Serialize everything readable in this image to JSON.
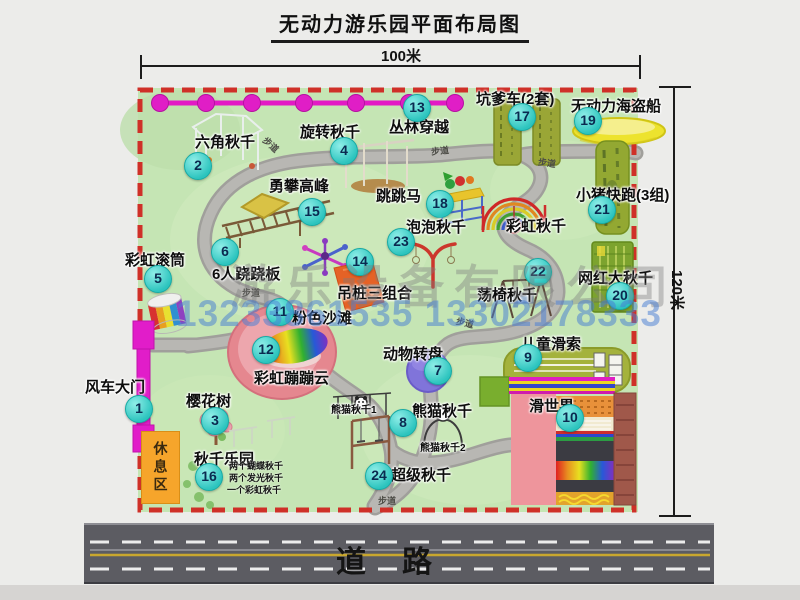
{
  "title": "无动力游乐园平面布局图",
  "dimensions": {
    "top": "100米",
    "right": "120米"
  },
  "road": {
    "label": "道路"
  },
  "watermark": {
    "company": "游乐设备有限公司",
    "phone": "13233861535 13302178333"
  },
  "rest_area": "休息区",
  "items": [
    {
      "num": 1,
      "label": "风车大门",
      "lx": 85,
      "ly": 376,
      "bx": 139,
      "by": 409
    },
    {
      "num": 2,
      "label": "六角秋千",
      "lx": 195,
      "ly": 131,
      "bx": 198,
      "by": 166
    },
    {
      "num": 3,
      "label": "樱花树",
      "lx": 186,
      "ly": 390,
      "bx": 215,
      "by": 421
    },
    {
      "num": 4,
      "label": "旋转秋千",
      "lx": 300,
      "ly": 121,
      "bx": 344,
      "by": 151
    },
    {
      "num": 5,
      "label": "彩虹滚筒",
      "lx": 125,
      "ly": 249,
      "bx": 158,
      "by": 279
    },
    {
      "num": 6,
      "label": "6人跷跷板",
      "lx": 212,
      "ly": 263,
      "bx": 225,
      "by": 252
    },
    {
      "num": 7,
      "label": "动物转盘",
      "lx": 383,
      "ly": 343,
      "bx": 438,
      "by": 371
    },
    {
      "num": 8,
      "label": "熊猫秋千",
      "lx": 412,
      "ly": 400,
      "bx": 403,
      "by": 423
    },
    {
      "num": 9,
      "label": "儿童滑索",
      "lx": 521,
      "ly": 333,
      "bx": 528,
      "by": 358
    },
    {
      "num": 10,
      "label": "滑世界",
      "lx": 529,
      "ly": 395,
      "bx": 570,
      "by": 418
    },
    {
      "num": 11,
      "label": "粉色沙滩",
      "lx": 292,
      "ly": 307,
      "bx": 280,
      "by": 312
    },
    {
      "num": 12,
      "label": "彩虹蹦蹦云",
      "lx": 254,
      "ly": 367,
      "bx": 266,
      "by": 350
    },
    {
      "num": 13,
      "label": "丛林穿越",
      "lx": 389,
      "ly": 116,
      "bx": 417,
      "by": 108
    },
    {
      "num": 14,
      "label": "吊桩三组合",
      "lx": 337,
      "ly": 282,
      "bx": 360,
      "by": 262
    },
    {
      "num": 15,
      "label": "勇攀高峰",
      "lx": 269,
      "ly": 175,
      "bx": 312,
      "by": 212
    },
    {
      "num": 16,
      "label": "秋千乐园",
      "lx": 194,
      "ly": 448,
      "bx": 209,
      "by": 477,
      "sub": [
        {
          "t": "两个蝴蝶秋千",
          "x": 229,
          "y": 459
        },
        {
          "t": "两个发光秋千",
          "x": 229,
          "y": 471
        },
        {
          "t": "一个彩虹秋千",
          "x": 227,
          "y": 483
        }
      ]
    },
    {
      "num": 17,
      "label": "坑爹车(2套)",
      "lx": 476,
      "ly": 88,
      "bx": 522,
      "by": 117
    },
    {
      "num": 18,
      "label": "跳跳马",
      "lx": 376,
      "ly": 185,
      "bx": 440,
      "by": 204
    },
    {
      "num": 19,
      "label": "无动力海盗船",
      "lx": 571,
      "ly": 95,
      "bx": 588,
      "by": 121
    },
    {
      "num": 20,
      "label": "网红大秋千",
      "lx": 578,
      "ly": 267,
      "bx": 620,
      "by": 296
    },
    {
      "num": 21,
      "label": "小猪快跑(3组)",
      "lx": 576,
      "ly": 184,
      "bx": 602,
      "by": 210
    },
    {
      "num": 22,
      "label": "荡椅秋千",
      "lx": 477,
      "ly": 284,
      "bx": 538,
      "by": 272
    },
    {
      "num": 23,
      "label": "泡泡秋千",
      "lx": 406,
      "ly": 216,
      "bx": 401,
      "by": 242
    },
    {
      "num": 24,
      "label": "超级秋千",
      "lx": 391,
      "ly": 464,
      "bx": 379,
      "by": 476
    }
  ],
  "extra_labels": [
    {
      "t": "彩虹秋千",
      "x": 506,
      "y": 215,
      "s": 15
    },
    {
      "t": "熊猫秋千1",
      "x": 331,
      "y": 401,
      "s": 10
    },
    {
      "t": "熊猫秋千2",
      "x": 420,
      "y": 439,
      "s": 10
    }
  ],
  "path_labels": [
    {
      "t": "步道",
      "x": 262,
      "y": 138,
      "r": 42
    },
    {
      "t": "步道",
      "x": 431,
      "y": 144,
      "r": -6
    },
    {
      "t": "步道",
      "x": 538,
      "y": 156,
      "r": 8
    },
    {
      "t": "步道",
      "x": 242,
      "y": 286,
      "r": 0
    },
    {
      "t": "步道",
      "x": 456,
      "y": 316,
      "r": 14
    },
    {
      "t": "步道",
      "x": 378,
      "y": 494,
      "r": 0
    }
  ]
}
